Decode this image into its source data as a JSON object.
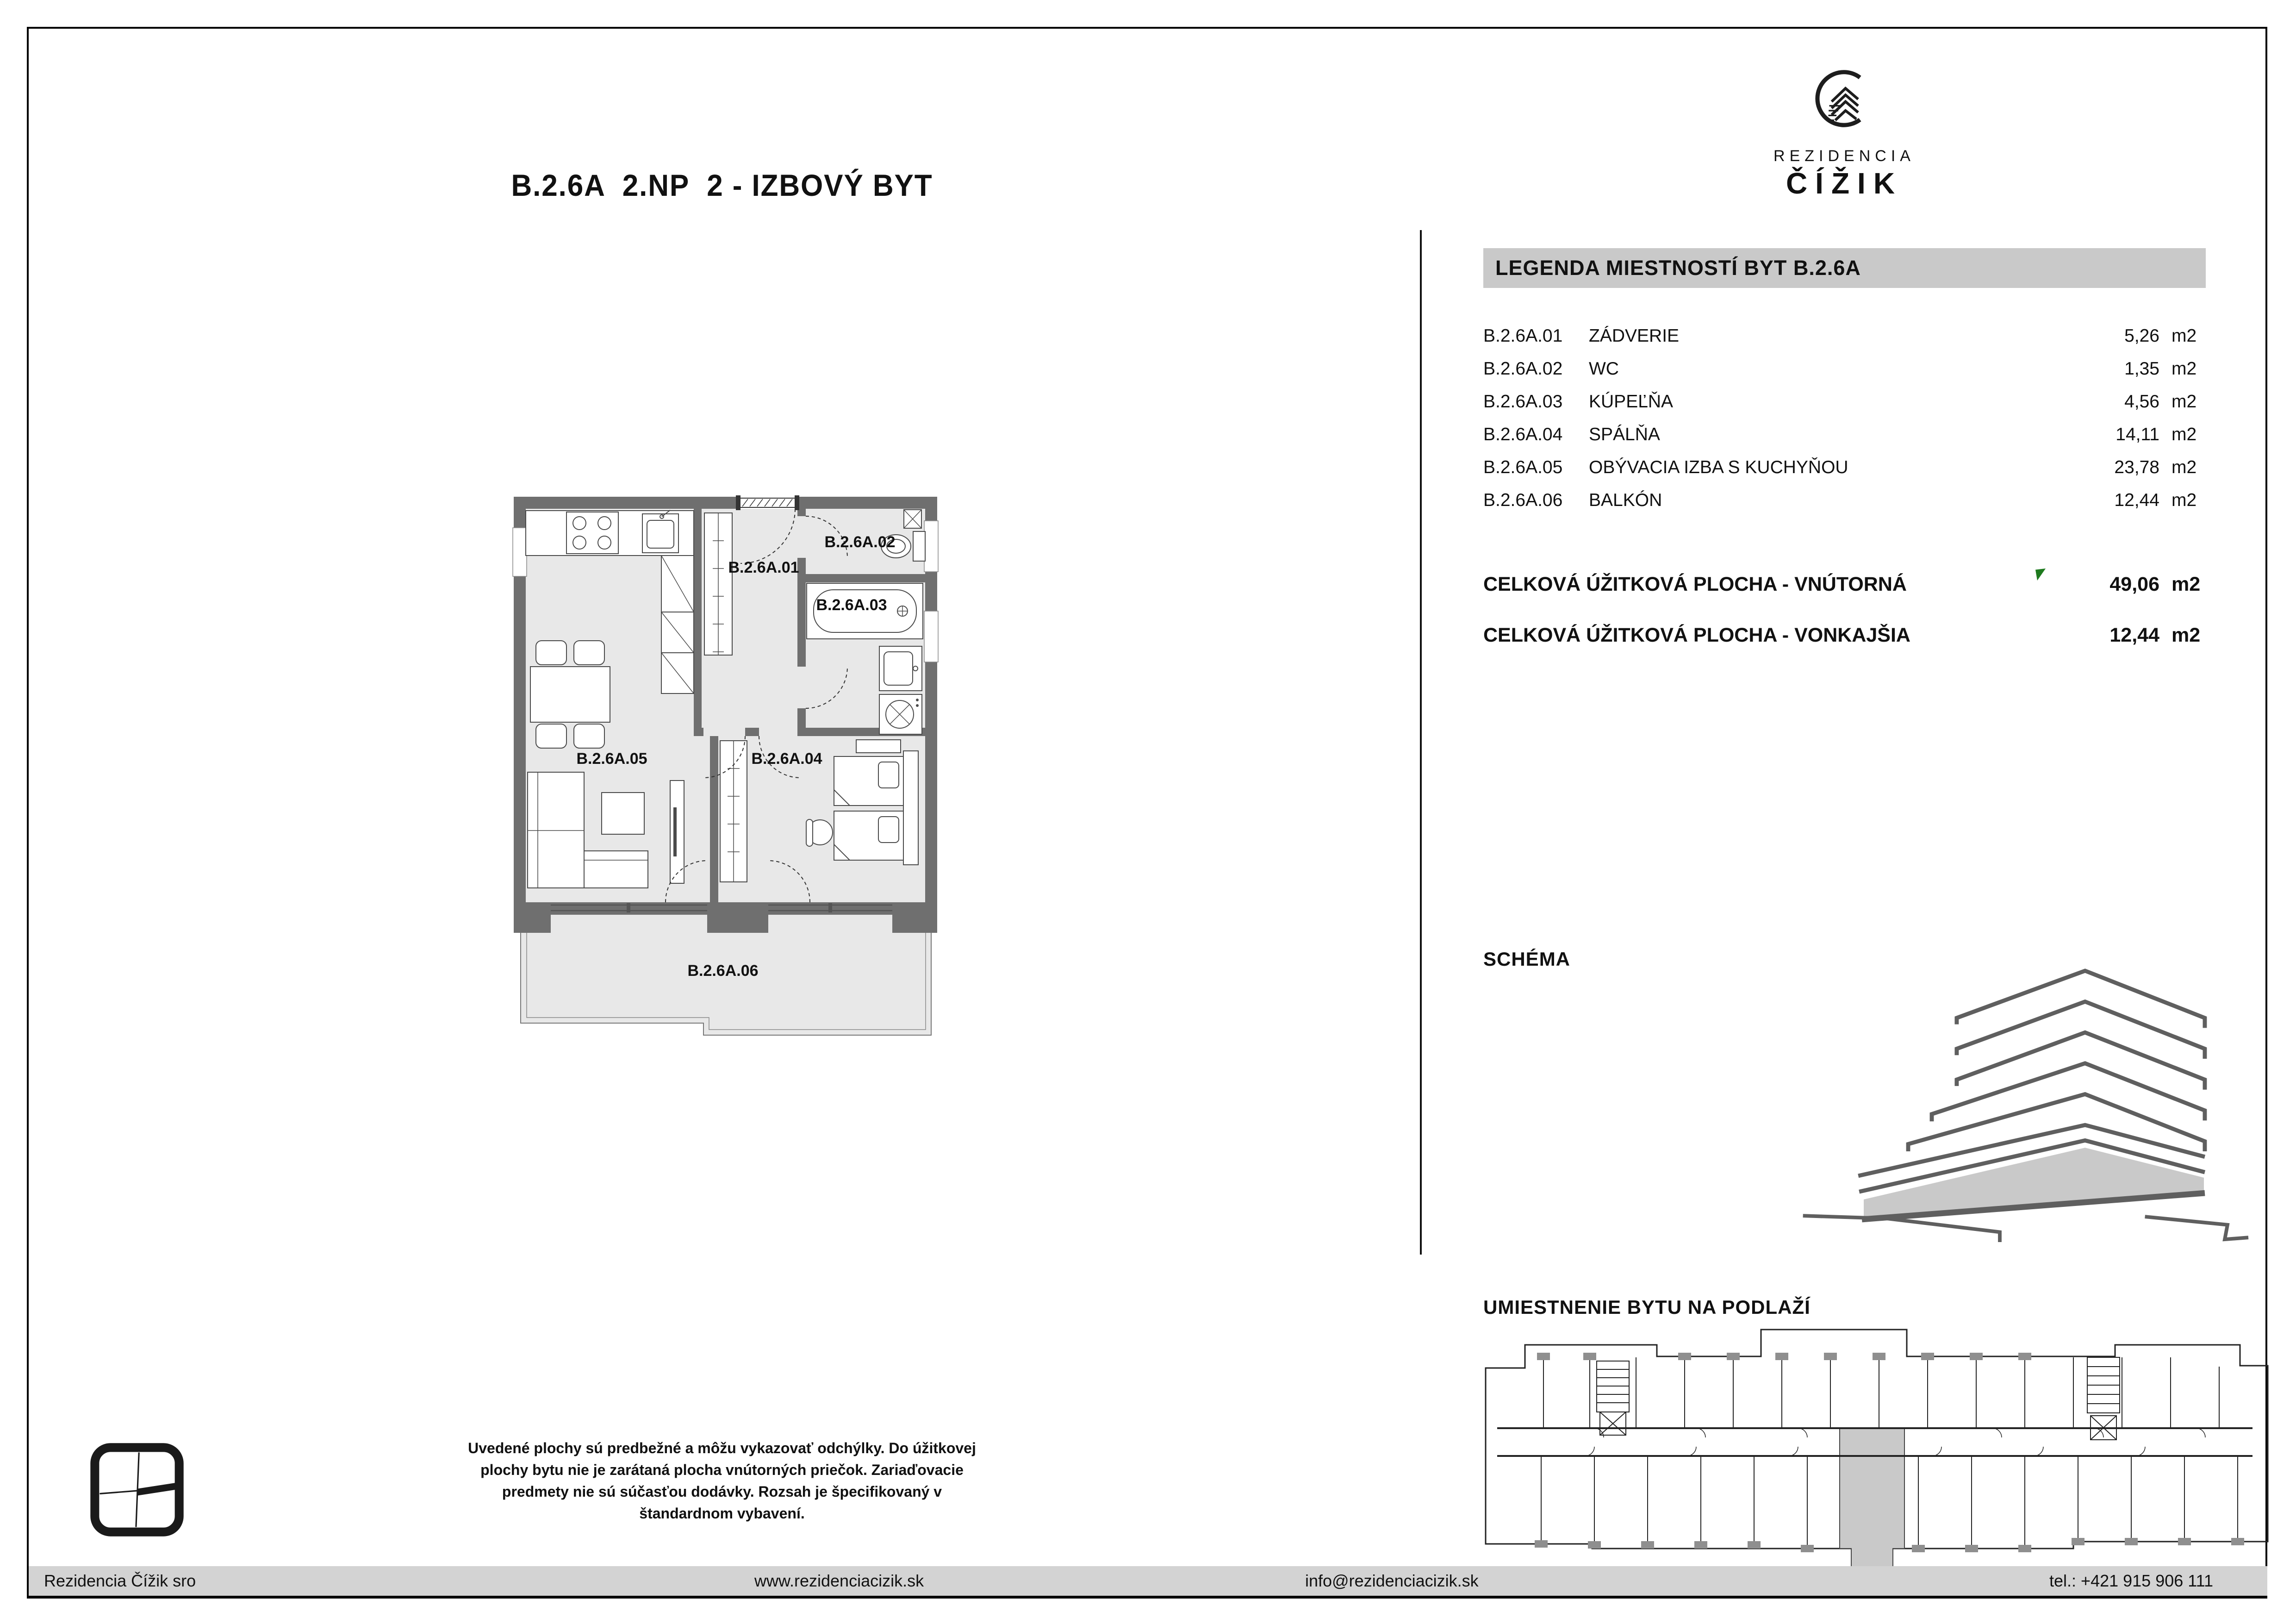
{
  "page": {
    "title": "B.2.6A  2.NP  2 - IZBOVÝ BYT"
  },
  "brand": {
    "name_line1": "REZIDENCIA",
    "name_line2": "ČÍŽIK"
  },
  "legend": {
    "header": "LEGENDA MIESTNOSTÍ BYT B.2.6A",
    "rooms": [
      {
        "code": "B.2.6A.01",
        "name": "ZÁDVERIE",
        "area": "5,26",
        "unit": "m2"
      },
      {
        "code": "B.2.6A.02",
        "name": "WC",
        "area": "1,35",
        "unit": "m2"
      },
      {
        "code": "B.2.6A.03",
        "name": "KÚPEĽŇA",
        "area": "4,56",
        "unit": "m2"
      },
      {
        "code": "B.2.6A.04",
        "name": "SPÁLŇA",
        "area": "14,11",
        "unit": "m2"
      },
      {
        "code": "B.2.6A.05",
        "name": "OBÝVACIA IZBA S KUCHYŇOU",
        "area": "23,78",
        "unit": "m2"
      },
      {
        "code": "B.2.6A.06",
        "name": "BALKÓN",
        "area": "12,44",
        "unit": "m2"
      }
    ],
    "totals": [
      {
        "label": "CELKOVÁ ÚŽITKOVÁ PLOCHA - VNÚTORNÁ",
        "area": "49,06",
        "unit": "m2"
      },
      {
        "label": "CELKOVÁ ÚŽITKOVÁ PLOCHA - VONKAJŠIA",
        "area": "12,44",
        "unit": "m2"
      }
    ]
  },
  "plan": {
    "labels": {
      "r01": "B.2.6A.01",
      "r02": "B.2.6A.02",
      "r03": "B.2.6A.03",
      "r04": "B.2.6A.04",
      "r05": "B.2.6A.05",
      "r06": "B.2.6A.06"
    }
  },
  "sections": {
    "schema": "SCHÉMA",
    "location": "UMIESTNENIE BYTU NA PODLAŽÍ"
  },
  "disclaimer": {
    "lines": [
      "Uvedené plochy sú predbežné a môžu vykazovať odchýlky. Do úžitkovej",
      "plochy bytu nie je zarátaná plocha vnútorných priečok. Zariaďovacie",
      "predmety nie sú súčasťou dodávky. Rozsah je špecifikovaný v",
      "štandardnom vybavení."
    ]
  },
  "footer": {
    "company": "Rezidencia Čížik sro",
    "website": "www.rezidenciacizik.sk",
    "email": "info@rezidenciacizik.sk",
    "phone": "tel.: +421 915 906 111"
  },
  "colors": {
    "wall": "#6f6f6f",
    "floor": "#e8e8e8",
    "header_bg": "#c9c9c9",
    "footer_bg": "#d3d3d3",
    "accent_green": "#1e7a1e",
    "schema_stroke": "#5f5f5f",
    "highlight": "#c9c9c9"
  }
}
